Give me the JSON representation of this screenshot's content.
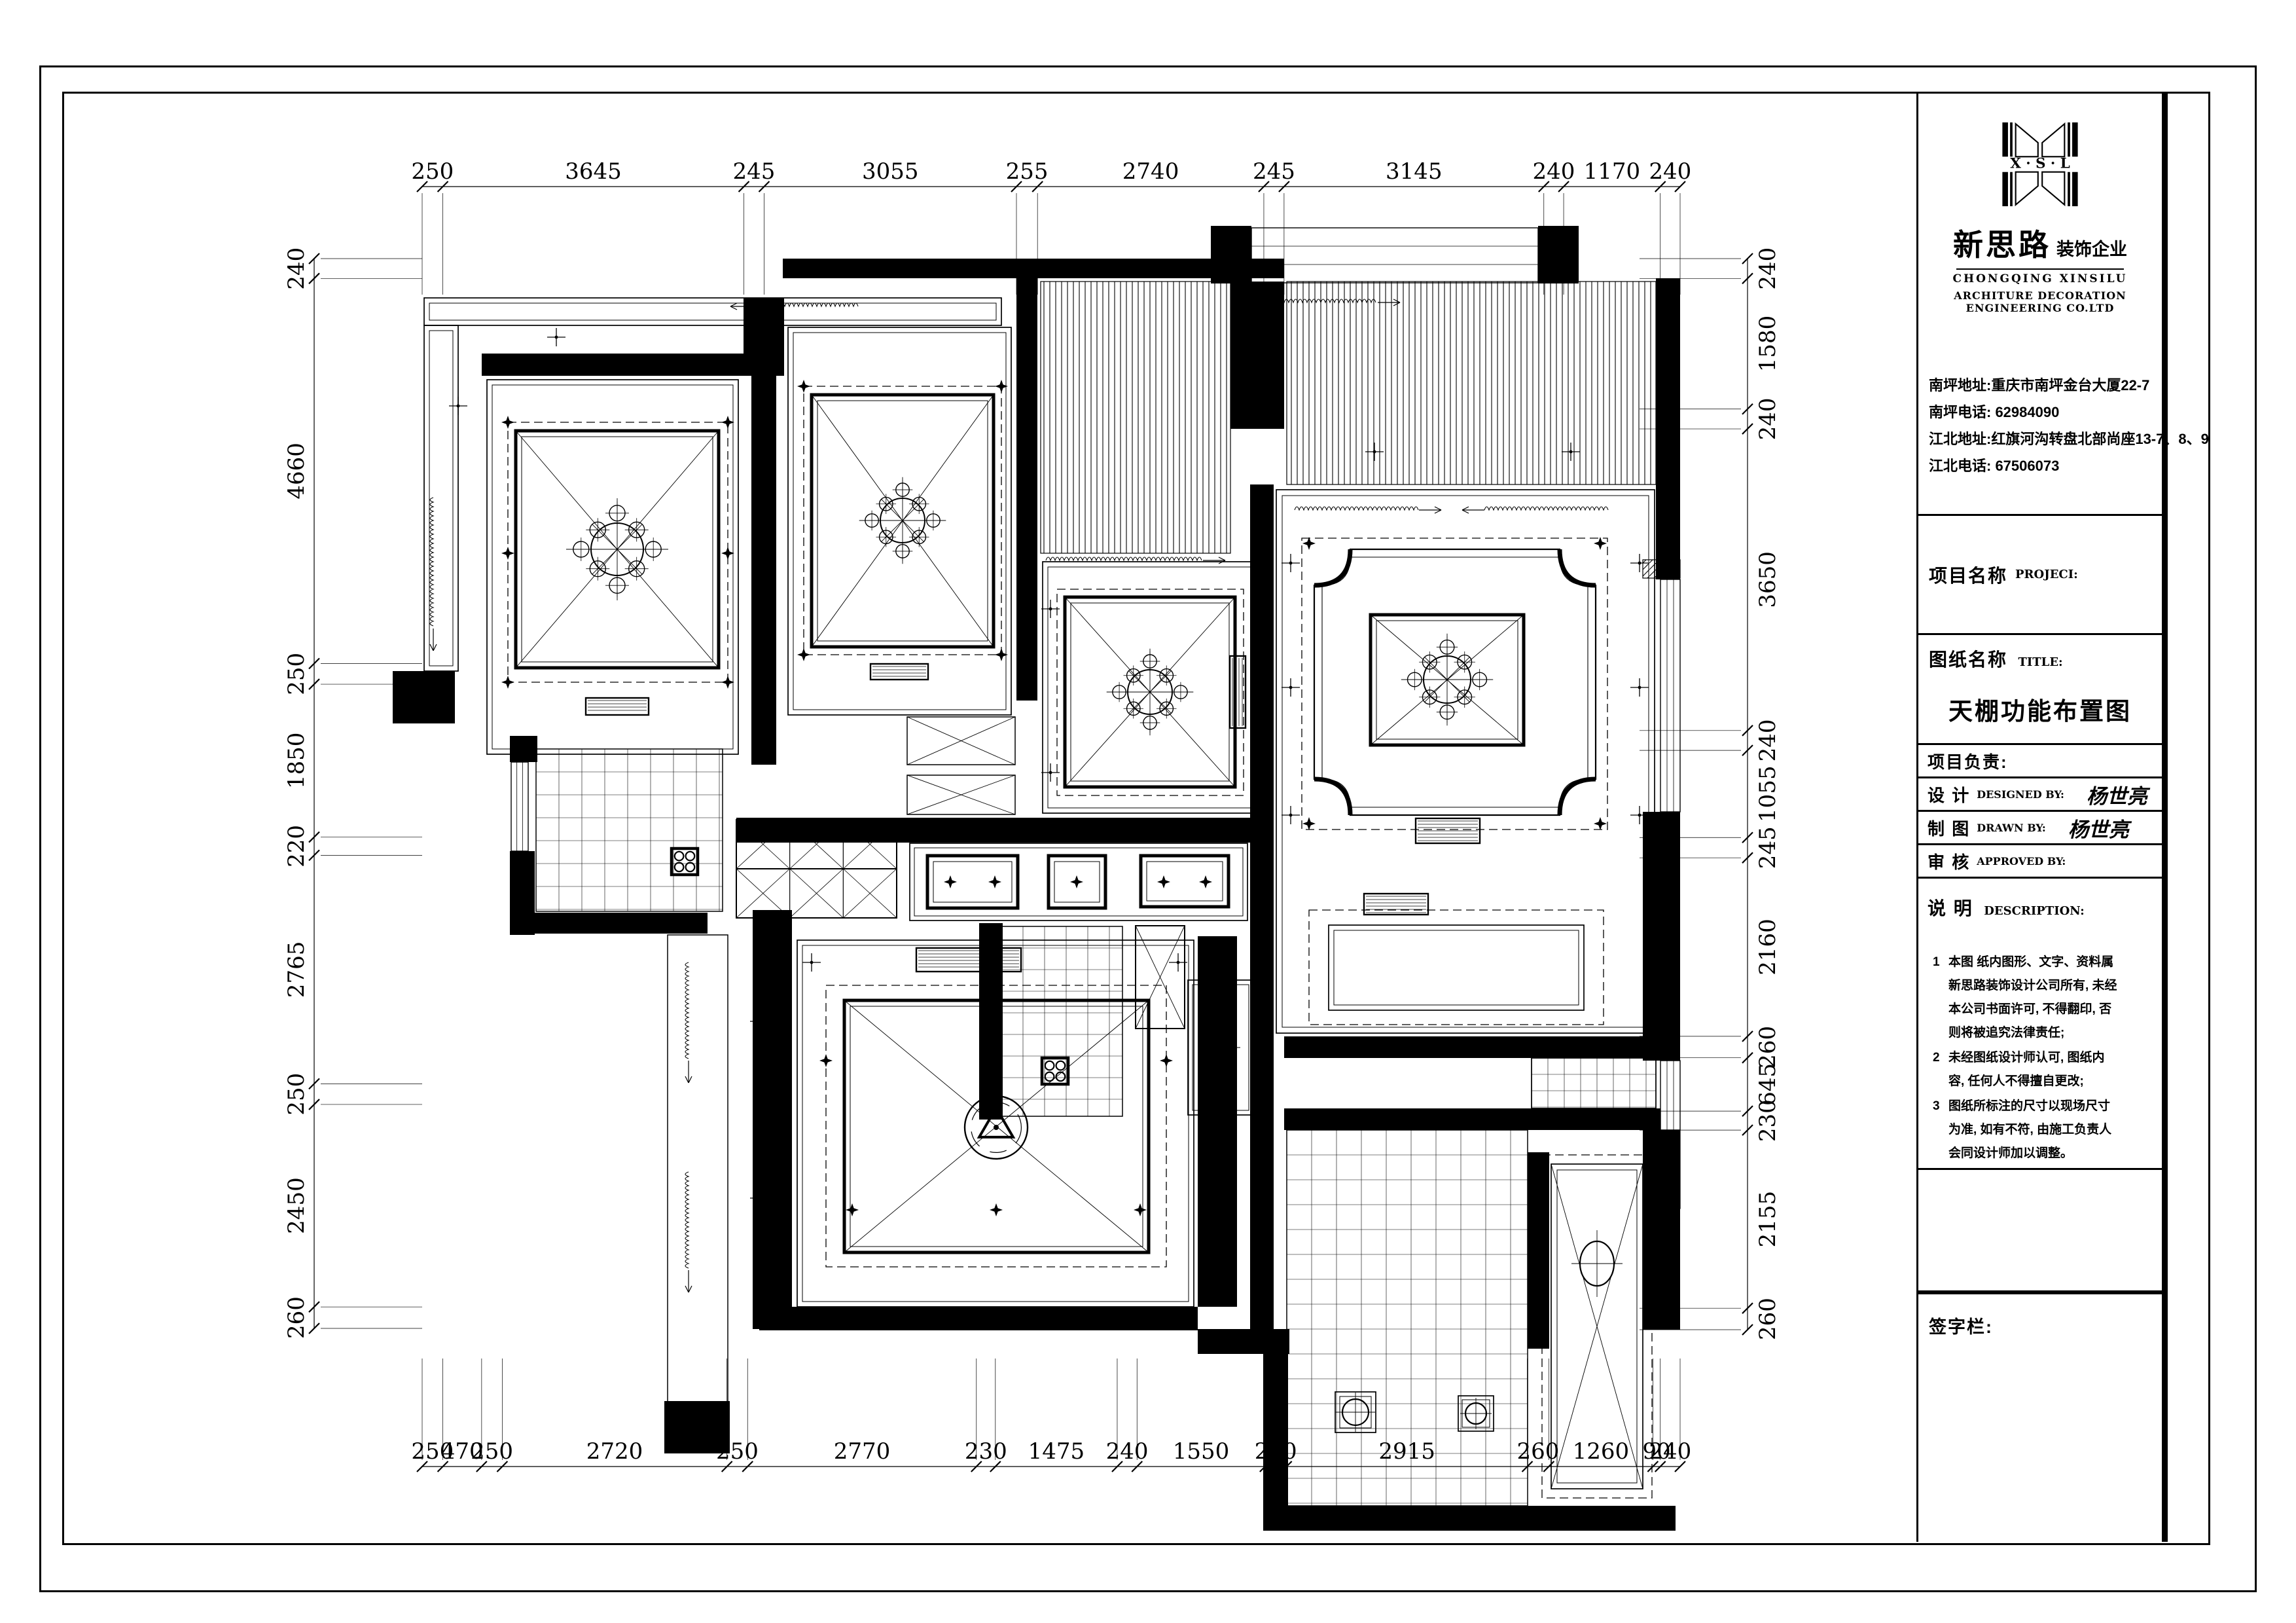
{
  "title_block": {
    "logo_letters": "X · S · L",
    "brand_cn": "新思路",
    "brand_sub": "装饰企业",
    "brand_en1": "CHONGQING XINSILU",
    "brand_en2": "ARCHITURE DECORATION ENGINEERING CO.LTD",
    "addresses": [
      "南坪地址:重庆市南坪金台大厦22-7",
      "南坪电话: 62984090",
      "江北地址:红旗河沟转盘北部尚座13-7、8、9",
      "江北电话: 67506073"
    ],
    "project_label_cn": "项目名称",
    "project_label_en": "PROJECI:",
    "drawing_label_cn": "图纸名称",
    "drawing_label_en": "TITLE:",
    "drawing_title": "天棚功能布置图",
    "rows": [
      {
        "cn": "项目负责:",
        "en": "",
        "value": ""
      },
      {
        "cn": "设  计",
        "en": "DESIGNED BY:",
        "value": "杨世亮"
      },
      {
        "cn": "制  图",
        "en": "DRAWN BY:",
        "value": "杨世亮"
      },
      {
        "cn": "审  核",
        "en": "APPROVED BY:",
        "value": ""
      }
    ],
    "desc_label_cn": "说  明",
    "desc_label_en": "DESCRIPTION:",
    "desc_items": [
      {
        "n": "1",
        "text": "本图 纸内图形、文字、资料属新思路装饰设计公司所有, 未经本公司书面许可, 不得翻印, 否则将被追究法律责任;"
      },
      {
        "n": "2",
        "text": "未经图纸设计师认可, 图纸内容, 任何人不得擅自更改;"
      },
      {
        "n": "3",
        "text": "图纸所标注的尺寸以现场尺寸为准, 如有不符, 由施工负责人会同设计师加以调整。"
      }
    ],
    "signature_label": "签字栏:"
  },
  "dimensions": {
    "rulers": [
      {
        "name": "top",
        "axis": "x",
        "values": [
          250,
          3645,
          245,
          3055,
          255,
          2740,
          245,
          3145,
          240,
          1170,
          240
        ],
        "line": 285,
        "from": 645,
        "to": 2567,
        "ext": 165,
        "extSign": 1,
        "labelOff": -12
      },
      {
        "name": "bottom",
        "axis": "x",
        "values": [
          250,
          470,
          250,
          2720,
          250,
          2770,
          230,
          1475,
          240,
          1550,
          260,
          2915,
          260,
          1260,
          90,
          240
        ],
        "line": 2240,
        "from": 645,
        "to": 2567,
        "ext": 165,
        "extSign": -1,
        "labelOff": -12
      },
      {
        "name": "left",
        "axis": "y",
        "values": [
          240,
          4660,
          250,
          1850,
          220,
          2765,
          250,
          2450,
          260
        ],
        "line": 480,
        "from": 395,
        "to": 2029,
        "ext": 165,
        "extSign": 1,
        "labelOff": -16
      },
      {
        "name": "right",
        "axis": "y",
        "values": [
          240,
          1580,
          240,
          3650,
          240,
          1055,
          245,
          2160,
          260,
          645,
          230,
          2155,
          260
        ],
        "line": 2670,
        "from": 395,
        "to": 2031,
        "ext": 165,
        "extSign": -1,
        "labelOff": 42
      }
    ]
  },
  "plan": {
    "walls": [
      [
        736,
        540,
        400,
        34
      ],
      [
        1136,
        455,
        62,
        119
      ],
      [
        1148,
        574,
        38,
        594
      ],
      [
        1196,
        395,
        766,
        30
      ],
      [
        1553,
        425,
        32,
        645
      ],
      [
        1850,
        345,
        62,
        88
      ],
      [
        2350,
        345,
        62,
        88
      ],
      [
        1880,
        430,
        82,
        225
      ],
      [
        2530,
        425,
        37,
        460
      ],
      [
        2510,
        1240,
        57,
        380
      ],
      [
        2510,
        1726,
        57,
        305
      ],
      [
        1160,
        1996,
        670,
        36
      ],
      [
        600,
        1025,
        95,
        80
      ],
      [
        779,
        1124,
        42,
        40
      ],
      [
        779,
        1300,
        38,
        128
      ],
      [
        803,
        1394,
        278,
        32
      ],
      [
        1150,
        1390,
        60,
        640
      ],
      [
        1125,
        1249,
        785,
        38
      ],
      [
        1910,
        740,
        36,
        1290
      ],
      [
        1496,
        1410,
        36,
        300
      ],
      [
        1830,
        1430,
        60,
        566
      ],
      [
        1930,
        2300,
        630,
        38
      ],
      [
        1830,
        2030,
        140,
        38
      ],
      [
        1930,
        2068,
        38,
        232
      ],
      [
        2334,
        1760,
        33,
        300
      ],
      [
        1962,
        1583,
        575,
        33
      ],
      [
        1962,
        1693,
        575,
        33
      ],
      [
        1015,
        2140,
        100,
        80
      ]
    ],
    "drects": [
      [
        648,
        455,
        882,
        42,
        8
      ],
      [
        648,
        497,
        52,
        528,
        8
      ],
      [
        744,
        580,
        384,
        572,
        8
      ],
      [
        1204,
        500,
        341,
        592,
        8
      ],
      [
        1593,
        858,
        330,
        384,
        8
      ],
      [
        1950,
        748,
        578,
        830,
        9
      ],
      [
        2030,
        1413,
        390,
        130,
        8
      ],
      [
        1218,
        1436,
        606,
        560,
        8
      ],
      [
        1390,
        1288,
        516,
        118,
        7
      ],
      [
        2370,
        1778,
        140,
        496,
        9
      ],
      [
        2040,
        2126,
        62,
        62,
        7
      ],
      [
        2228,
        2132,
        54,
        54,
        6
      ],
      [
        1815,
        1497,
        100,
        206,
        7
      ]
    ],
    "rects": [
      [
        1020,
        1428,
        92,
        714,
        1.5
      ],
      [
        1735,
        1414,
        75,
        157,
        2
      ],
      [
        1386,
        1095,
        165,
        73,
        1.5
      ],
      [
        1386,
        1184,
        165,
        60,
        1.5
      ],
      [
        2340,
        1616,
        190,
        77,
        1.5
      ]
    ],
    "dashes": [
      [
        776,
        645,
        336,
        397
      ],
      [
        1228,
        590,
        302,
        410
      ],
      [
        1615,
        900,
        285,
        315
      ],
      [
        1989,
        822,
        467,
        445
      ],
      [
        2000,
        1390,
        450,
        175
      ],
      [
        1262,
        1505,
        520,
        430
      ],
      [
        2356,
        1764,
        168,
        524
      ]
    ],
    "trects": [
      [
        788,
        658,
        310,
        362
      ],
      [
        1240,
        603,
        278,
        385
      ],
      [
        1627,
        912,
        260,
        290
      ],
      [
        2094,
        939,
        234,
        199
      ],
      [
        1290,
        1528,
        465,
        385
      ],
      [
        1417,
        1307,
        138,
        80
      ],
      [
        1602,
        1307,
        87,
        80
      ],
      [
        1743,
        1307,
        134,
        78
      ]
    ],
    "xrects": [
      [
        788,
        658,
        310,
        362
      ],
      [
        1240,
        603,
        278,
        385
      ],
      [
        1627,
        912,
        260,
        290
      ],
      [
        2094,
        939,
        234,
        199
      ],
      [
        1290,
        1528,
        465,
        385
      ],
      [
        1735,
        1414,
        75,
        157
      ],
      [
        2370,
        1778,
        140,
        496
      ],
      [
        1386,
        1095,
        165,
        73
      ],
      [
        1386,
        1184,
        165,
        60
      ]
    ],
    "grids": [
      [
        819,
        1144,
        285,
        248,
        35
      ],
      [
        1530,
        1415,
        185,
        290,
        33
      ],
      [
        1966,
        1726,
        368,
        574,
        38
      ],
      [
        2340,
        1616,
        190,
        77,
        25
      ]
    ],
    "xgrids": [
      [
        1125,
        1252,
        245,
        150,
        3,
        2
      ]
    ],
    "hatches": [
      [
        1590,
        430,
        290,
        415,
        "v"
      ],
      [
        1966,
        430,
        564,
        310,
        "v"
      ],
      [
        2532,
        1726,
        35,
        120,
        "d"
      ],
      [
        2510,
        855,
        57,
        28,
        "d"
      ]
    ],
    "vents": [
      [
        895,
        1066,
        96,
        26
      ],
      [
        1330,
        1014,
        88,
        24
      ],
      [
        1879,
        1002,
        24,
        110
      ],
      [
        2163,
        1250,
        98,
        38
      ],
      [
        2084,
        1365,
        98,
        32
      ],
      [
        1400,
        1448,
        160,
        36
      ]
    ],
    "meds": [
      [
        943,
        839,
        40
      ],
      [
        1379,
        795,
        34
      ],
      [
        1757,
        1057,
        34
      ],
      [
        2211,
        1038,
        36
      ]
    ],
    "fans": [
      [
        1522,
        1722,
        48
      ]
    ],
    "ovals": [
      [
        2440,
        1930,
        26,
        34
      ],
      [
        1865,
        1600,
        20,
        26
      ],
      [
        2071,
        2157,
        20,
        20
      ],
      [
        2255,
        2159,
        16,
        16
      ]
    ],
    "quads": [
      [
        1046,
        1316,
        40
      ],
      [
        1612,
        1636,
        40
      ]
    ],
    "squiggles": [
      [
        1150,
        468,
        165,
        "h",
        -1
      ],
      [
        1955,
        462,
        150,
        "h",
        1
      ],
      [
        662,
        760,
        200,
        "v",
        1
      ],
      [
        1598,
        856,
        240,
        "h",
        1
      ],
      [
        1978,
        779,
        190,
        "h",
        1
      ],
      [
        2268,
        779,
        190,
        "h",
        -1
      ],
      [
        1052,
        1470,
        150,
        "v",
        1
      ],
      [
        1052,
        1790,
        150,
        "v",
        1
      ]
    ],
    "pluses": [
      [
        850,
        515
      ],
      [
        700,
        620
      ],
      [
        1972,
        860
      ],
      [
        2505,
        860
      ],
      [
        1972,
        1245
      ],
      [
        2505,
        1245
      ],
      [
        1972,
        1050
      ],
      [
        2505,
        1050
      ],
      [
        1160,
        1560
      ],
      [
        1160,
        1830
      ],
      [
        1240,
        1470
      ],
      [
        1800,
        1470
      ],
      [
        1605,
        930
      ],
      [
        1605,
        1180
      ],
      [
        2100,
        690
      ],
      [
        2400,
        690
      ]
    ],
    "dias": [
      [
        776,
        645
      ],
      [
        1112,
        645
      ],
      [
        776,
        1042
      ],
      [
        1112,
        1042
      ],
      [
        776,
        845
      ],
      [
        1112,
        845
      ],
      [
        1228,
        590
      ],
      [
        1530,
        590
      ],
      [
        1228,
        1000
      ],
      [
        1530,
        1000
      ],
      [
        1302,
        1848
      ],
      [
        1522,
        1848
      ],
      [
        1742,
        1848
      ],
      [
        1262,
        1620
      ],
      [
        1782,
        1620
      ],
      [
        2000,
        830
      ],
      [
        2445,
        830
      ],
      [
        2000,
        1258
      ],
      [
        2445,
        1258
      ],
      [
        1452,
        1347
      ],
      [
        1520,
        1347
      ],
      [
        1645,
        1347
      ],
      [
        1778,
        1347
      ],
      [
        1842,
        1347
      ]
    ],
    "cframes": [
      [
        2008,
        839,
        430,
        406,
        55
      ]
    ],
    "wins": [
      [
        2537,
        885,
        30,
        355,
        "v"
      ],
      [
        2537,
        1620,
        30,
        106,
        "v"
      ],
      [
        1912,
        348,
        438,
        84,
        "h"
      ],
      [
        781,
        1164,
        26,
        136,
        "v"
      ]
    ]
  }
}
